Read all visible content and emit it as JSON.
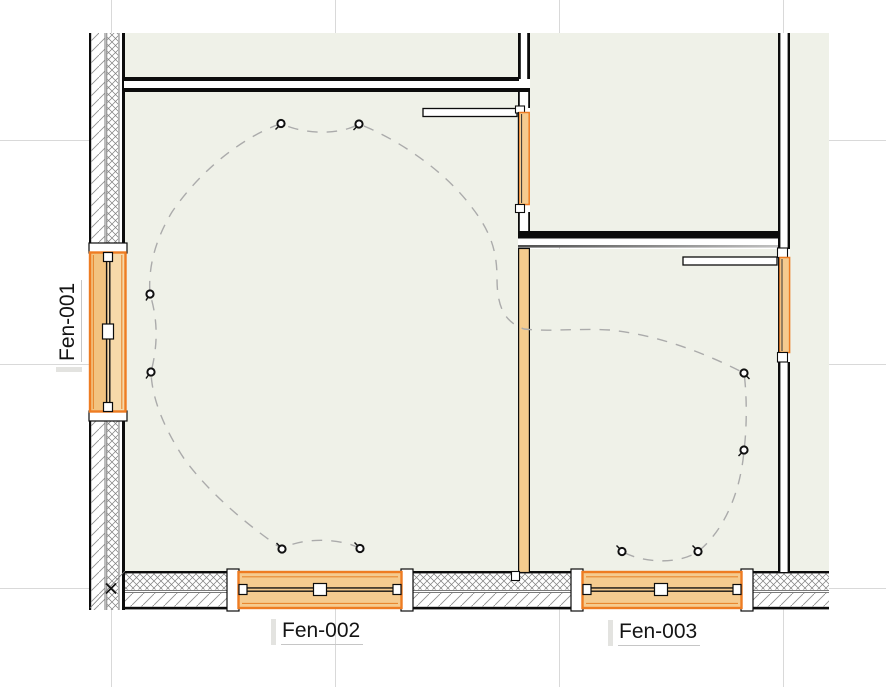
{
  "view": {
    "type": "cad-floor-plan",
    "background": "#ffffff",
    "grid_color": "#d9d9d9"
  },
  "colors": {
    "room_fill": "#EFF1E8",
    "window_frame_orange": "#EE7C22",
    "window_fill": "#F5CB8F",
    "window_fill_outer": "#F2C380",
    "window_fill_inner": "#F7D9A9",
    "orange_wall_fill": "#F5CC8E",
    "hatch_gray": "#8f8f8f",
    "wiring_dash_gray": "#ABABAB",
    "line_black": "#0c0c0c"
  },
  "windows": [
    {
      "id": "fen-001",
      "label": "Fen-001"
    },
    {
      "id": "fen-002",
      "label": "Fen-002"
    },
    {
      "id": "fen-003",
      "label": "Fen-003"
    }
  ],
  "symbols": {
    "ceiling_light": "small open circle",
    "ceiling_light_count": 10,
    "wiring": "dashed gray curve linking lights",
    "origin_marker": "small black x at grid intersection"
  }
}
